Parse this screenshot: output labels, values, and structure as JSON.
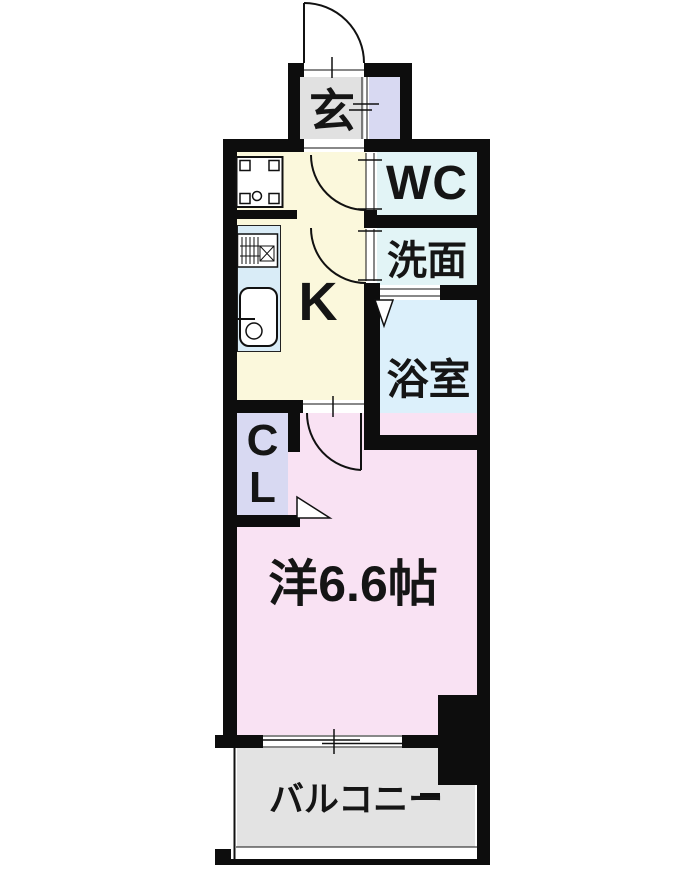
{
  "floorplan": {
    "type": "japanese-apartment-1k-floorplan",
    "rooms": {
      "entrance": {
        "label": "玄"
      },
      "wc": {
        "label": "WC"
      },
      "washroom": {
        "label": "洗面"
      },
      "bathroom": {
        "label": "浴室"
      },
      "kitchen": {
        "label": "K"
      },
      "closet": {
        "line1": "C",
        "line2": "L"
      },
      "western_room": {
        "label": "洋6.6帖"
      },
      "balcony": {
        "label": "バルコニー"
      }
    },
    "colors": {
      "wall": "#0d0d0d",
      "entrance_floor": "#e1e1e1",
      "shoe_storage_floor": "#d8d9f2",
      "kitchen_floor": "#fbf8dc",
      "wc_floor": "#e2f4f6",
      "washroom_floor": "#e2f4f6",
      "bathroom_floor": "#dcf0fb",
      "closet_floor": "#d8d9f2",
      "western_room_floor": "#f9e2f3",
      "balcony_floor": "#e3e3e3",
      "kitchen_counter": "#d9ecf7",
      "background": "#ffffff"
    }
  }
}
